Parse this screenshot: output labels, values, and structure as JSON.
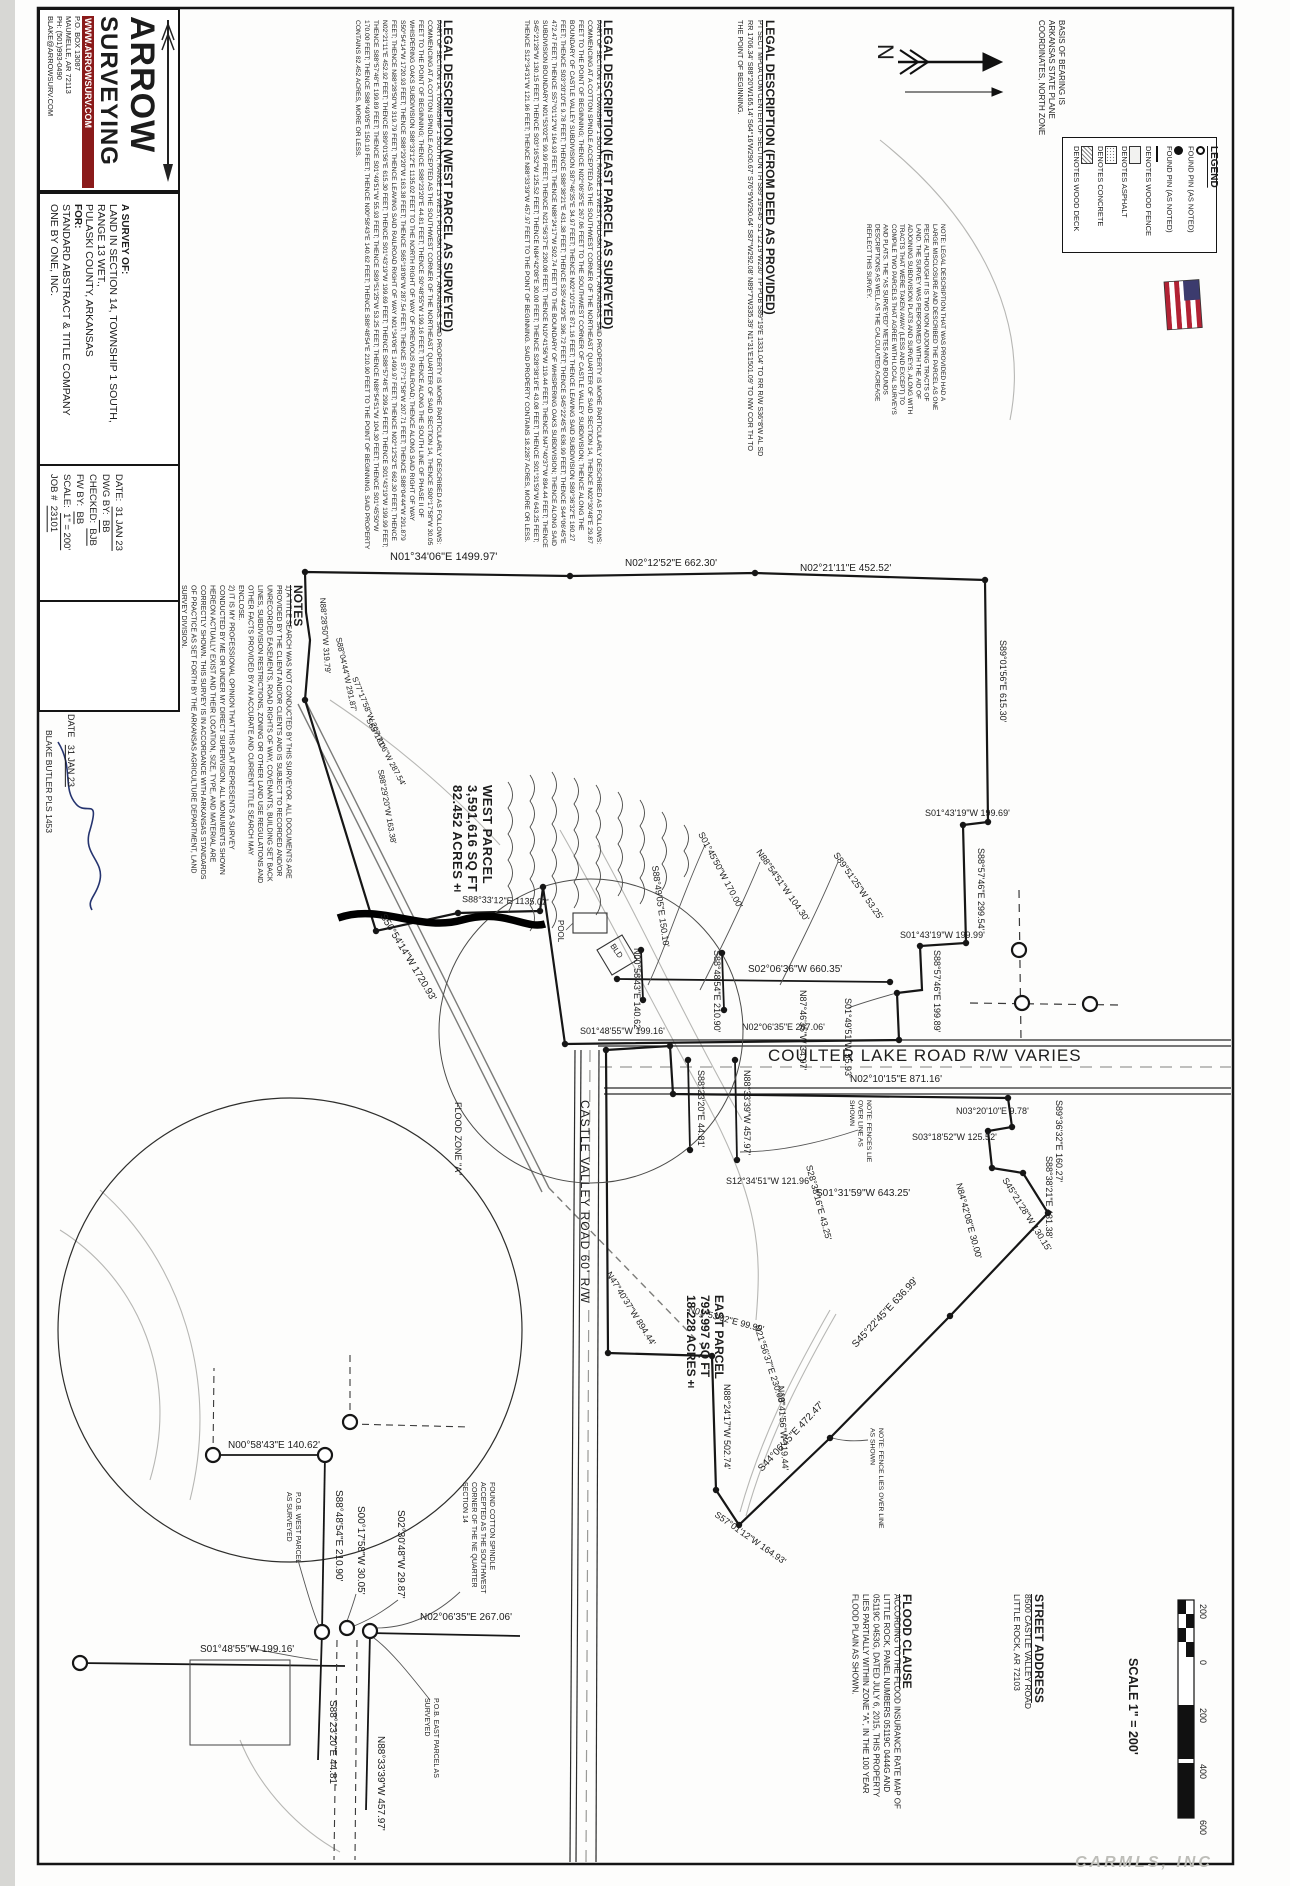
{
  "watermark": "CARMLS, INC",
  "basis_of_bearing": "BASIS OF BEARING IS ARKANSAS STATE PLANE COORDINATES, NORTH ZONE",
  "provided_note": "NOTE:  LEGAL DESCRIPTION THAT WAS PROVIDED HAD A LARGE MISCLOSURE AND DESCRIBED THE PARCEL AS ONE PEICE ALTHOUGH IT IS TWO NON ADJOINING TRACTS OF LAND.  THE SURVEY WAS PERFORMED WITH THE AID OF ADJOINING SUBDIVISION PLATS AND SURVEYS, ALONG WITH TRACTS THAT WERE TAKEN AWAY (LESS AND EXCEPT) TO COMPILE TWO PARCELS THAT AGREE WITH LOCAL SURVEYS AND PLATS.  THE \"AS SURVEYED\" METES AND BOUNDS DESCRIPTIONS AS WELL AS THE CALCULATED ACREAGE REFLECT THIS SURVEY.",
  "legend": {
    "title": "LEGEND",
    "items": [
      {
        "icon": "found-pin-open-icon",
        "label": "FOUND PIN (AS NOTED)"
      },
      {
        "icon": "found-pin-filled-icon",
        "label": "FOUND PIN (AS NOTED)"
      },
      {
        "icon": "wood-fence-line-icon",
        "label": "DENOTES WOOD FENCE"
      },
      {
        "icon": "asphalt-swatch-icon",
        "label": "DENOTES ASPHALT"
      },
      {
        "icon": "concrete-swatch-icon",
        "label": "DENOTES CONCRETE"
      },
      {
        "icon": "wood-deck-swatch-icon",
        "label": "DENOTES WOOD DECK"
      }
    ]
  },
  "legal_deed": {
    "title": "LEGAL DESCRIPTION (FROM DEED AS PROVIDED)",
    "body": "PT SECT MPDA COM CENTER OF SECTION TH S89°19'E45' S1°12'19\"W230' TP POB S89°19'E 1331.04' TO RR R/W S36°8'W AL SD RR 1706.34' S88°20'W165.14' S64°16'W290.67' S76°9'W290.64' S87°W292.08' N89°7'W335.39' N1°31'E1501.09' TO NW COR TH TO THE POINT OF BEGINNING."
  },
  "legal_east": {
    "title": "LEGAL DESCRIPTION (EAST PARCEL AS SURVEYED)",
    "body": "PART OF SECTION 14, TOWNSHIP 1 SOUTH, RANGE 13 WEST, PULASKI COUNTY, ARKANSAS.  SAID PROPERTY IS MORE PARTICULARLY DESCRIBED AS FOLLOWS:  COMMENCING AT A COTTON SPINDLE ACCEPTED AS THE SOUTHWEST CORNER OF THE NORTHEAST QUARTER OF SAID SECTION 14, THENCE N02°30'48\"E 29.87 FEET TO THE POINT OF BEGINNING; THENCE N02°06'35\"E 267.06 FEET TO THE SOUTHWEST CORNER OF CASTLE VALLEY SUBDIVISION; THENCE ALONG THE BOUNDARY OF CASTLE VALLEY SUBDIVISION S87°46'35\"E 34.97 FEET; THENCE N02°10'15\"E 871.16 FEET; THENCE LEAVING SAID SUBDIVISION S89°36'32\"E 160.27 FEET; THENCE S03°20'10\"E 9.78 FEET; THENCE S88°38'21\"E 431.38 FEET; THENCE S35°44'29\"E 396.72 FEET; THENCE S45°22'45\"E 636.99 FEET; THENCE S44°06'45\"E 472.47 FEET; THENCE S57°01'12\"W 164.93 FEET; THENCE N88°24'17\"W 502.74 FEET TO THE BOUNDARY OF WHISPERING OAKS SUBDIVISION; THENCE ALONG SAID SUBDIVISION BOUNDARY N01°53'02\"E 99.99 FEET; THENCE N21°56'37\"E 230.08 FEET; THENCE N10°41'56\"W 119.44 FEET; THENCE N47°40'37\"W 894.44 FEET; THENCE S45°21'28\"W 130.15 FEET; THENCE S03°16'52\"W 125.52 FEET; THENCE N84°42'08\"E 30.00 FEET; THENCE S28°38'16\"E 43.08 FEET; THENCE S01°31'59\"W 643.25 FEET; THENCE S12°34'31\"W 121.96 FEET; THENCE N88°33'39\"W 457.97 FEET TO THE POINT OF BEGINNING.  SAID PROPERTY CONTAINS 18.2287 ACRES, MORE OR LESS."
  },
  "legal_west": {
    "title": "LEGAL DESCRIPTION (WEST PARCEL AS SURVEYED)",
    "body": "PART OF SECTION 14, TOWNSHIP 1 SOUTH, RANGE 13 WEST, PULASKI COUNTY, ARKANSAS.  SAID PROPERTY IS MORE PARTICULARLY DESCRIBED AS FOLLOWS:  COMMENCING AT A COTTON SPINDLE ACCEPTED AS THE SOUTHWEST CORNER OF THE NORTHEAST QUARTER OF SAID SECTION 14, THENCE S00°17'58\"W 30.05 FEET TO THE POINT OF BEGINNING; THENCE S88°23'20\"E 44.81 FEET; THENCE S0°48'55\"W 199.16 FEET; THENCE ALONG THE SOUTH LINE OF PHASE II OF WHISPERING OAKS SUBDIVISION S88°33'12\"E 1135.02 FEET TO THE NORTH RIGHT OF WAY OF PREVIOUS RAILROAD; THENCE ALONG SAID RIGHT OF WAY S50°54'14\"W 1720.93 FEET; THENCE S88°29'20\"W 163.38 FEET; THENCE S65°18'06\"W 287.54 FEET; THENCE S77°17'58\"W 207.71 FEET; THENCE S88°04'44\"W 291.879 FEET; THENCE N88°28'50\"W 319.79 FEET; THENCE LEAVING SAID RAILROAD RIGHT OF WAY N01°34'06\"E 1499.97 FEET; THENCE N02°12'52\"E 662.30 FEET; THENCE N02°21'11\"E 452.92 FEET; THENCE S89°01'56\"E 615.30 FEET; THENCE S01°43'19\"W 199.69 FEET; THENCE S88°57'46\"E 299.54 FEET; THENCE S01°43'19\"W 199.99 FEET; THENCE S88°57'46\"E 199.89 FEET; THENCE S01°49'51\"W 55.93 FEET; THENCE S89°51'25\"W 53.25 FEET; THENCE N88°54'51\"W 104.30 FEET; THENCE S01°45'50\"W 170.00 FEET; THENCE S88°49'05\"E 150.10 FEET; THENCE N00°58'43\"E 140.62 FEET; THENCE S88°48'54\"E 210.90 FEET TO THE POINT OF BEGINNING.  SAID PROPERTY CONTAINS 82.452 ACRES, MORE OR LESS."
  },
  "notes": {
    "title": "NOTES",
    "item1": "1)    A TITLE SEARCH WAS NOT CONDUCTED BY THIS SURVEYOR. ALL DOCUMENTS ARE PROVIDED BY THE CLIENT AND/OR CLIENTS AND IS SUBJECT TO RECORDED AND/OR UNRECORDED EASEMENTS, ROAD RIGHTS OF WAY, COVENANTS, BUILDING SET BACK LINES, SUBDIVISION RESTRICTIONS, ZONING OR OTHER LAND USE REGULATIONS AND OTHER FACTS PROVIDED BY AN ACCURATE AND CURRENT TITLE SEARCH MAY ENCLOSE.",
    "item2": "2)    IT IS MY PROFESSIONAL OPINION THAT THIS PLAT REPRESENTS A SURVEY CONDUCTED BY ME OR UNDER MY DIRECT SUPERVISION. ALL MONUMENTS SHOWN HEREON ACTUALLY EXIST AND THEIR LOCATION, SIZE, TYPE, AND MATERIAL ARE CORRECTLY SHOWN. THIS SURVEY IS IN ACCORDANCE WITH ARKANSAS STANDARDS OF PRACTICE AS SET FORTH BY THE ARKANSAS AGRICULTURE DEPARTMENT, LAND SURVEY DIVISION."
  },
  "title_block": {
    "logo": {
      "name1": "ARROW",
      "name2": "SURVEYING",
      "website": "WWW.ARROWSURV.COM",
      "addr1": "P.O. BOX 13087",
      "addr2": "MAUMELLE, AR 72113",
      "phone": "PH: (501)993-0490",
      "email": "BLAKE@ARROWSURV.COM"
    },
    "survey_of_label": "A SURVEY OF:",
    "survey_of_line1": "LAND IN SECTION 14, TOWNSHIP 1 SOUTH, RANGE 13 WET.,",
    "survey_of_line2": "PULASKI COUNTY, ARKANSAS",
    "for_label": "FOR:",
    "client_line1": "STANDARD ABSTRACT & TITLE COMPANY",
    "client_line2": "ONE BY ONE, INC.",
    "fields": [
      {
        "label": "DATE:",
        "value": "31 JAN 23"
      },
      {
        "label": "DWG BY:",
        "value": "BB"
      },
      {
        "label": "CHECKED:",
        "value": "BJB"
      },
      {
        "label": "FW BY:",
        "value": "BB"
      },
      {
        "label": "SCALE:",
        "value": "1\" = 200'"
      },
      {
        "label": "JOB #",
        "value": "23101"
      }
    ],
    "seal": {
      "ring_top": "REGISTERED PROFESSIONAL",
      "ring_bottom": "LAND SURVEYOR",
      "line1": "STATE OF",
      "line2": "ARKANSAS",
      "line3": "No. 1457"
    },
    "surveyor": "BLAKE BUTLER PLS 1453",
    "date_label": "DATE",
    "date_value": "31 JAN 23"
  },
  "street_address": {
    "title": "STREET ADDRESS",
    "line1": "8500 CASTLE VALLEY ROAD",
    "line2": "LITTLE ROCK, AR 72103"
  },
  "flood_clause": {
    "title": "FLOOD CLAUSE",
    "body": "ACCORDING TO THE FLOOD INSURANCE RATE MAP OF LITTLE ROCK, PANEL NUMBERS 05119C 0444G AND 05119C 0453G, DATED JULY 6, 2015, THIS PROPERTY LIES PARTIALLY WITHIN ZONE \"A\", IN THE 100 YEAR FLOOD PLAIN AS SHOWN."
  },
  "scale": {
    "label": "SCALE  1\" = 200'",
    "ticks": [
      "200",
      "0",
      "200",
      "400",
      "600"
    ]
  },
  "parcels": {
    "west": {
      "name": "WEST PARCEL",
      "sqft": "3,591,616 SQ FT",
      "acres": "82.452 ACRES±"
    },
    "east": {
      "name": "EAST PARCEL",
      "sqft": "793,997 SQ FT",
      "acres": "18.228 ACRES±"
    }
  },
  "roads": {
    "coulter": "COULTER LAKE ROAD  R/W VARIES",
    "castle": "CASTLE VALLEY ROAD  60' R/W"
  },
  "callouts": {
    "fence_note1": "NOTE: FENCES LIE OVER LINE AS SHOWN",
    "fence_note2": "NOTE: FENCE LIES OVER LINE AS SHOWN",
    "pob_west": "P.O.B. WEST PARCEL AS SURVEYED",
    "pob_east": "P.O.B. EAST PARCEL AS SURVEYED",
    "spindle": "FOUND COTTON SPINDLE ACCEPTED AS THE SOUTHWEST CORNER OF THE NE QUARTER SECTION 14"
  },
  "plat": {
    "labels": [
      {
        "t": "N01°34'06\"E  1499.97'",
        "x": 390,
        "y": 560,
        "r": 0,
        "s": 11
      },
      {
        "t": "N02°12'52\"E  662.30'",
        "x": 625,
        "y": 566,
        "r": 0,
        "s": 10
      },
      {
        "t": "N02°21'11\"E  452.52'",
        "x": 800,
        "y": 571,
        "r": 0,
        "s": 10
      },
      {
        "t": "S89°01'56\"E  615.30'",
        "x": 1000,
        "y": 640,
        "r": 90,
        "s": 9
      },
      {
        "t": "S01°43'19\"W  199.69'",
        "x": 925,
        "y": 816,
        "r": 0,
        "s": 9
      },
      {
        "t": "S88°57'46\"E  299.54'",
        "x": 978,
        "y": 848,
        "r": 90,
        "s": 9
      },
      {
        "t": "S01°43'19\"W  199.99'",
        "x": 900,
        "y": 938,
        "r": 0,
        "s": 9
      },
      {
        "t": "S88°57'46\"E  199.89'",
        "x": 934,
        "y": 950,
        "r": 90,
        "s": 9
      },
      {
        "t": "S01°49'51\"W  55.93'",
        "x": 845,
        "y": 998,
        "r": 90,
        "s": 9
      },
      {
        "t": "N87°46'35\"W  34.97'",
        "x": 800,
        "y": 990,
        "r": 90,
        "s": 9
      },
      {
        "t": "N88°54'51\"W  104.30'",
        "x": 756,
        "y": 852,
        "r": 55,
        "s": 9
      },
      {
        "t": "S01°45'50\"W  170.00'",
        "x": 698,
        "y": 834,
        "r": 62,
        "s": 9
      },
      {
        "t": "S89°51'25\"W  53.25'",
        "x": 833,
        "y": 855,
        "r": 55,
        "s": 9
      },
      {
        "t": "S88°49'05\"E  150.10'",
        "x": 652,
        "y": 866,
        "r": 82,
        "s": 9
      },
      {
        "t": "N00°58'43\"E  140.62'",
        "x": 634,
        "y": 948,
        "r": 90,
        "s": 9
      },
      {
        "t": "S88°48'54\"E  210.90'",
        "x": 714,
        "y": 950,
        "r": 90,
        "s": 9
      },
      {
        "t": "S01°48'55\"W  199.16'",
        "x": 580,
        "y": 1034,
        "r": 0,
        "s": 9
      },
      {
        "t": "S88°23'20\"E  44.81'",
        "x": 698,
        "y": 1070,
        "r": 90,
        "s": 9
      },
      {
        "t": "N88°33'39\"W  457.97'",
        "x": 744,
        "y": 1070,
        "r": 90,
        "s": 9
      },
      {
        "t": "N02°06'35\"E  267.06'",
        "x": 742,
        "y": 1030,
        "r": 0,
        "s": 9
      },
      {
        "t": "S02°06'36\"W  660.35'",
        "x": 748,
        "y": 972,
        "r": 0,
        "s": 10
      },
      {
        "t": "N02°10'15\"E  871.16'",
        "x": 850,
        "y": 1082,
        "r": 0,
        "s": 10
      },
      {
        "t": "N03°20'10\"E  9.78'",
        "x": 956,
        "y": 1114,
        "r": 0,
        "s": 9
      },
      {
        "t": "S03°18'52\"W  125.52'",
        "x": 912,
        "y": 1140,
        "r": 0,
        "s": 9
      },
      {
        "t": "S89°36'32\"E  160.27'",
        "x": 1056,
        "y": 1100,
        "r": 90,
        "s": 9
      },
      {
        "t": "S88°38'21\"E  431.38'",
        "x": 1046,
        "y": 1156,
        "r": 90,
        "s": 9
      },
      {
        "t": "S45°21'28\"W  130.15'",
        "x": 1002,
        "y": 1180,
        "r": 58,
        "s": 9
      },
      {
        "t": "N84°42'08\"E  30.00'",
        "x": 956,
        "y": 1184,
        "r": 75,
        "s": 9
      },
      {
        "t": "S28°38'16\"E  43.25'",
        "x": 806,
        "y": 1166,
        "r": 75,
        "s": 9
      },
      {
        "t": "S12°34'51\"W  121.96'",
        "x": 726,
        "y": 1184,
        "r": 0,
        "s": 9
      },
      {
        "t": "S01°31'59\"W  643.25'",
        "x": 816,
        "y": 1196,
        "r": 0,
        "s": 10
      },
      {
        "t": "S45°22'45\"E  636.99'",
        "x": 856,
        "y": 1348,
        "r": -47,
        "s": 10
      },
      {
        "t": "S44°06'45\"E  472.47'",
        "x": 762,
        "y": 1472,
        "r": -47,
        "s": 10
      },
      {
        "t": "N10°41'56\"W  119.44'",
        "x": 778,
        "y": 1386,
        "r": 87,
        "s": 9
      },
      {
        "t": "N21°56'37\"E  230.08'",
        "x": 754,
        "y": 1326,
        "r": 72,
        "s": 9
      },
      {
        "t": "N01°53'02\"E  99.99'",
        "x": 688,
        "y": 1312,
        "r": 15,
        "s": 9
      },
      {
        "t": "N88°24'17\"W  502.74'",
        "x": 724,
        "y": 1384,
        "r": 90,
        "s": 9
      },
      {
        "t": "S57°01'12\"W  164.93'",
        "x": 714,
        "y": 1516,
        "r": 35,
        "s": 9
      },
      {
        "t": "N47°40'37\"W  894.44'",
        "x": 606,
        "y": 1274,
        "r": 58,
        "s": 9
      },
      {
        "t": "S50°54'14\"W  1720.93'",
        "x": 380,
        "y": 916,
        "r": 59,
        "s": 10
      },
      {
        "t": "S88°33'12\"E  1135.02'",
        "x": 462,
        "y": 902,
        "r": 2,
        "s": 9
      },
      {
        "t": "N88°28'50\"W  319.79'",
        "x": 320,
        "y": 598,
        "r": 86,
        "s": 8
      },
      {
        "t": "S88°04'44\"W  291.87'",
        "x": 336,
        "y": 638,
        "r": 78,
        "s": 8
      },
      {
        "t": "S77°17'58\"W  207.71'",
        "x": 352,
        "y": 678,
        "r": 68,
        "s": 8
      },
      {
        "t": "S65°18'06\"W  287.54'",
        "x": 366,
        "y": 720,
        "r": 62,
        "s": 8
      },
      {
        "t": "S88°29'20\"W  163.38'",
        "x": 378,
        "y": 770,
        "r": 80,
        "s": 8
      },
      {
        "t": "FLOOD ZONE \"A\"",
        "x": 455,
        "y": 1102,
        "r": 90,
        "s": 9
      },
      {
        "t": "POOL",
        "x": 558,
        "y": 920,
        "r": 90,
        "s": 8
      },
      {
        "t": "BLD",
        "x": 610,
        "y": 946,
        "r": 55,
        "s": 8
      },
      {
        "t": "N",
        "x": 878,
        "y": 44,
        "r": 90,
        "s": 22
      },
      {
        "t": "N00°58'43\"E  140.62'",
        "x": 228,
        "y": 1448,
        "r": 0,
        "s": 10
      },
      {
        "t": "S88°48'54\"E  210.90'",
        "x": 336,
        "y": 1490,
        "r": 90,
        "s": 10
      },
      {
        "t": "S00°17'58\"W  30.05'",
        "x": 358,
        "y": 1506,
        "r": 90,
        "s": 10
      },
      {
        "t": "S02°30'48\"W  29.87'",
        "x": 398,
        "y": 1510,
        "r": 90,
        "s": 10
      },
      {
        "t": "N02°06'35\"E  267.06'",
        "x": 420,
        "y": 1620,
        "r": 0,
        "s": 10
      },
      {
        "t": "S01°48'55\"W  199.16'",
        "x": 200,
        "y": 1652,
        "r": 0,
        "s": 10
      },
      {
        "t": "S88°23'20\"E  44.81'",
        "x": 330,
        "y": 1700,
        "r": 90,
        "s": 10
      },
      {
        "t": "N88°33'39\"W  457.97'",
        "x": 378,
        "y": 1736,
        "r": 90,
        "s": 10
      }
    ]
  }
}
